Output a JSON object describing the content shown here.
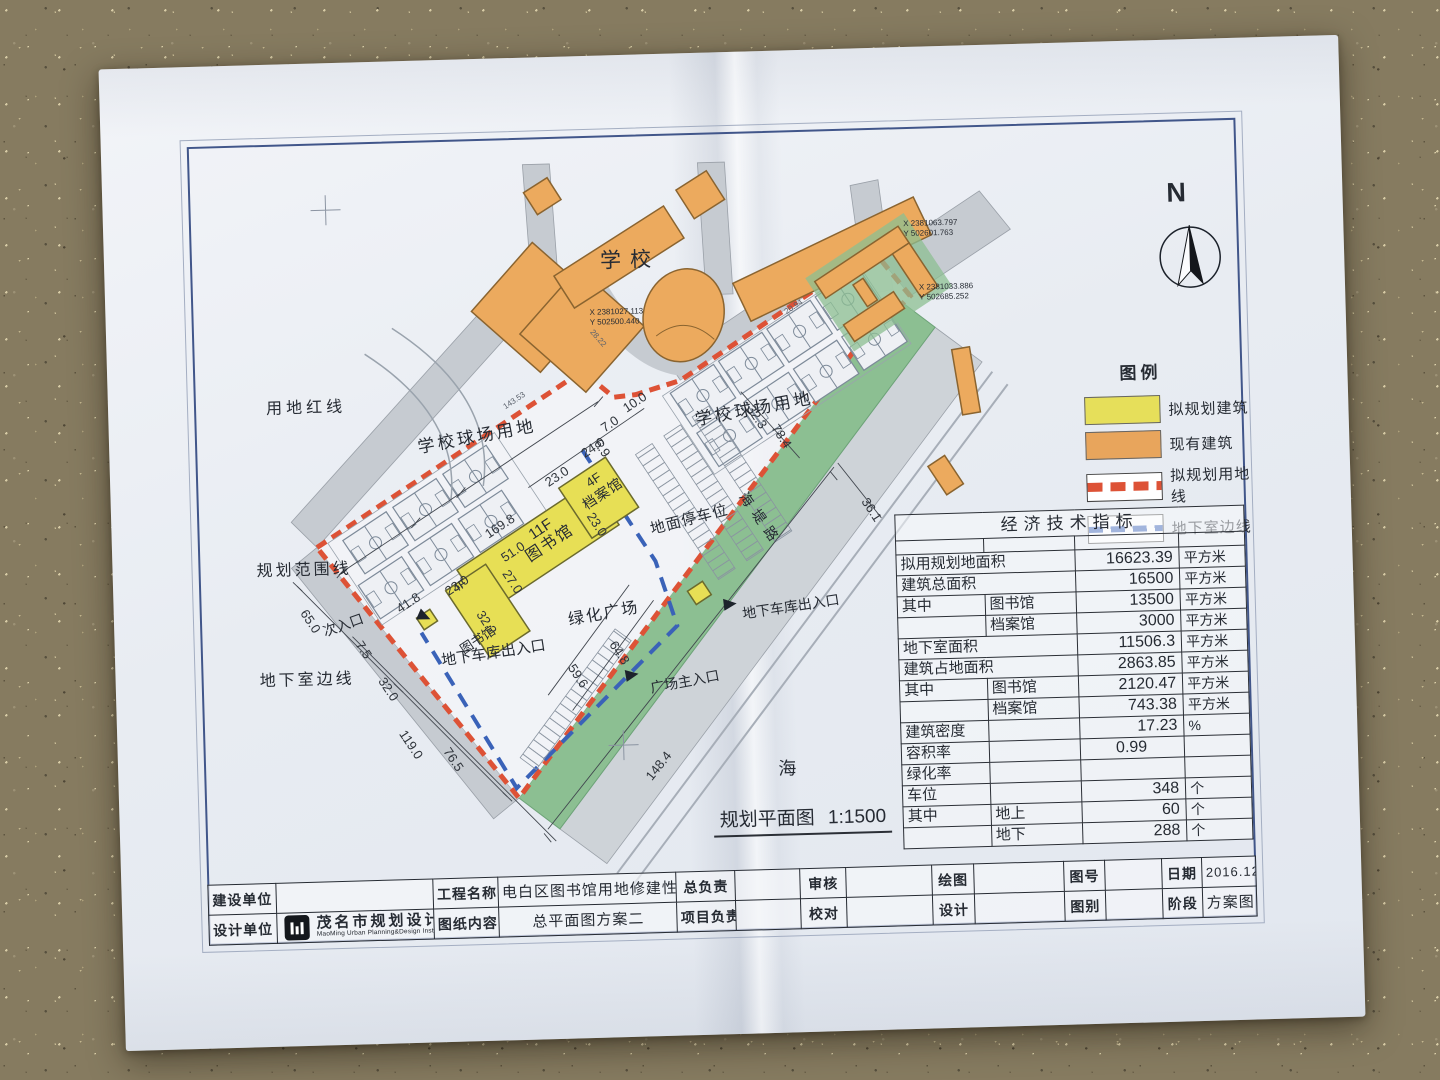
{
  "drawing": {
    "plan_caption": "规划平面图",
    "plan_scale": "1:1500",
    "north_letter": "N"
  },
  "legend": {
    "title": "图例",
    "items": [
      {
        "label": "拟规划建筑",
        "swatch_color": "#e6df5a"
      },
      {
        "label": "现有建筑",
        "swatch_color": "#e8a55c"
      },
      {
        "label": "拟规划用地线",
        "swatch_color": "#dd5236"
      },
      {
        "label": "地下室边线",
        "swatch_color": "#3a62b8"
      }
    ]
  },
  "econ_table": {
    "title": "经济技术指标",
    "rows": [
      [
        "拟用规划地面积",
        "",
        "16623.39",
        "平方米"
      ],
      [
        "建筑总面积",
        "",
        "16500",
        "平方米"
      ],
      [
        "其中",
        "图书馆",
        "13500",
        "平方米"
      ],
      [
        "",
        "档案馆",
        "3000",
        "平方米"
      ],
      [
        "地下室面积",
        "",
        "11506.3",
        "平方米"
      ],
      [
        "建筑占地面积",
        "",
        "2863.85",
        "平方米"
      ],
      [
        "其中",
        "图书馆",
        "2120.47",
        "平方米"
      ],
      [
        "",
        "档案馆",
        "743.38",
        "平方米"
      ],
      [
        "建筑密度",
        "",
        "17.23",
        "%"
      ],
      [
        "容积率",
        "",
        "0.99",
        ""
      ],
      [
        "绿化率",
        "",
        "",
        ""
      ],
      [
        "车位",
        "",
        "348",
        "个"
      ],
      [
        "其中",
        "地上",
        "60",
        "个"
      ],
      [
        "",
        "地下",
        "288",
        "个"
      ]
    ]
  },
  "title_block": {
    "row1": [
      "建设单位",
      "",
      "工程名称",
      "电白区图书馆用地修建性规划",
      "总负责",
      "",
      "审核",
      "",
      "绘图",
      "",
      "图号",
      "",
      "日期",
      "2016.12"
    ],
    "row2": [
      "设计单位",
      "",
      "图纸内容",
      "总平面图方案二",
      "项目负责",
      "",
      "校对",
      "",
      "设计",
      "",
      "图别",
      "",
      "阶段",
      "方案图"
    ],
    "design_firm_cn": "茂名市规划设计研究院",
    "design_firm_en": "MaoMing Urban Planning&Design Institute"
  },
  "map": {
    "labels": {
      "school": "学校",
      "land_red_line": "用地红线",
      "school_courts_left": "学校球场用地",
      "school_courts_right": "学校球场用地",
      "planning_range_line": "规划范围线",
      "secondary_entrance": "次入口",
      "basement_edge": "地下室边线",
      "garage_exit_left": "地下车库出入口",
      "garage_exit_right": "地下车库出入口",
      "plaza_main_entrance": "广场主入口",
      "library_floors": "11F",
      "library": "图书馆",
      "archive_floors": "4F",
      "archive": "档案馆",
      "library_wing_floors": "4F",
      "library_wing": "图书馆",
      "green_plaza": "绿化广场",
      "surface_parking": "地面停车位",
      "haidi_road": "海堤路",
      "sea": "海"
    },
    "coordinates": [
      {
        "x": "X 2381027.113",
        "y": "Y 502500.440"
      },
      {
        "x": "X 2381063.797",
        "y": "Y 502601.763"
      },
      {
        "x": "X 2381033.886",
        "y": "Y 502685.252"
      }
    ],
    "dimensions": [
      "169.8",
      "51.0",
      "23.0",
      "41.8",
      "23.0",
      "24.0",
      "10.0",
      "7.0",
      "6.9",
      "32.3",
      "78.4",
      "36.1",
      "27.0",
      "23.0",
      "32.2",
      "59.6",
      "64.8",
      "65.0",
      "7.5",
      "32.0",
      "119.0",
      "76.5",
      "148.4",
      "143.53",
      "28.22",
      "20.94"
    ]
  },
  "colors": {
    "proposed_building": "#e6df5a",
    "existing_building": "#e8a55c",
    "boundary_line": "#dd5236",
    "basement_line": "#3a62b8",
    "green_strip": "#8cbf92",
    "frame_blue": "#41568a"
  }
}
